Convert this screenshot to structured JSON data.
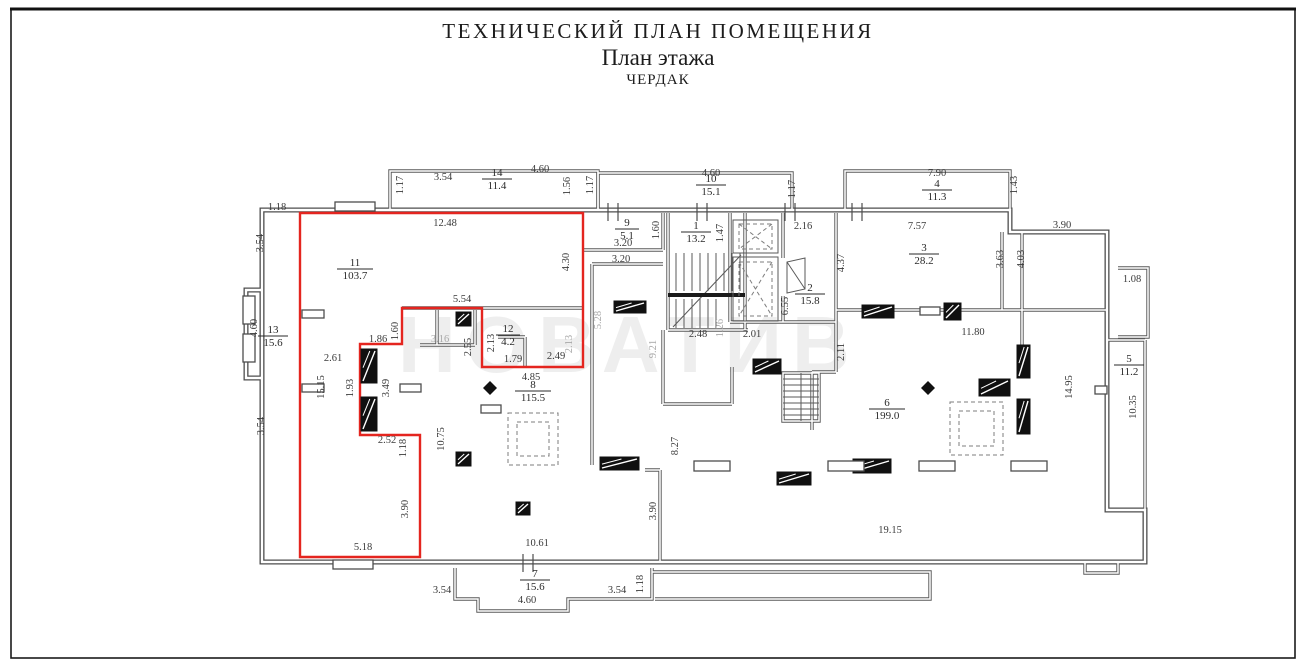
{
  "title": {
    "line1": "ТЕХНИЧЕСКИЙ ПЛАН ПОМЕЩЕНИЯ",
    "line2": "План этажа",
    "line3": "ЧЕРДАК"
  },
  "watermark": "НОВАТИВ",
  "colors": {
    "wall": "#4d4d4d",
    "red_outline": "#e4251f",
    "dim": "#3a3a3a",
    "dim_gray": "#a8a8a8",
    "room": "#2a2a2a"
  },
  "plan": {
    "rooms": [
      {
        "num": "14",
        "area": "11.4",
        "x": 497,
        "y": 178
      },
      {
        "num": "10",
        "area": "15.1",
        "x": 711,
        "y": 184
      },
      {
        "num": "4",
        "area": "11.3",
        "x": 937,
        "y": 189
      },
      {
        "num": "9",
        "area": "5.1",
        "x": 627,
        "y": 228
      },
      {
        "num": "1",
        "area": "13.2",
        "x": 696,
        "y": 231
      },
      {
        "num": "11",
        "area": "103.7",
        "x": 355,
        "y": 268
      },
      {
        "num": "3",
        "area": "28.2",
        "x": 924,
        "y": 253
      },
      {
        "num": "2",
        "area": "15.8",
        "x": 810,
        "y": 293
      },
      {
        "num": "12",
        "area": "4.2",
        "x": 508,
        "y": 334
      },
      {
        "num": "13",
        "area": "15.6",
        "x": 273,
        "y": 335
      },
      {
        "num": "8",
        "area": "115.5",
        "x": 533,
        "y": 390
      },
      {
        "num": "6",
        "area": "199.0",
        "x": 887,
        "y": 408
      },
      {
        "num": "5",
        "area": "11.2",
        "x": 1129,
        "y": 364
      },
      {
        "num": "7",
        "area": "15.6",
        "x": 535,
        "y": 579
      }
    ],
    "dims": [
      {
        "t": "1.18",
        "x": 277,
        "y": 210
      },
      {
        "t": "3.54",
        "x": 263,
        "y": 243,
        "r": 1
      },
      {
        "t": "1.17",
        "x": 403,
        "y": 185,
        "r": 1
      },
      {
        "t": "3.54",
        "x": 443,
        "y": 180
      },
      {
        "t": "4.60",
        "x": 540,
        "y": 172
      },
      {
        "t": "1.56",
        "x": 570,
        "y": 186,
        "r": 1
      },
      {
        "t": "1.17",
        "x": 593,
        "y": 185,
        "r": 1
      },
      {
        "t": "12.48",
        "x": 445,
        "y": 226
      },
      {
        "t": "4.60",
        "x": 711,
        "y": 176
      },
      {
        "t": "1.17",
        "x": 795,
        "y": 189,
        "r": 1
      },
      {
        "t": "7.90",
        "x": 937,
        "y": 176
      },
      {
        "t": "1.43",
        "x": 1017,
        "y": 185,
        "r": 1
      },
      {
        "t": "3.90",
        "x": 1062,
        "y": 228
      },
      {
        "t": "2.16",
        "x": 803,
        "y": 229
      },
      {
        "t": "7.57",
        "x": 917,
        "y": 229
      },
      {
        "t": "1.60",
        "x": 659,
        "y": 230,
        "r": 1
      },
      {
        "t": "3.20",
        "x": 623,
        "y": 246
      },
      {
        "t": "3.20",
        "x": 621,
        "y": 262
      },
      {
        "t": "1.47",
        "x": 723,
        "y": 233,
        "r": 1
      },
      {
        "t": "4.30",
        "x": 569,
        "y": 262,
        "r": 1
      },
      {
        "t": "4.37",
        "x": 844,
        "y": 263,
        "r": 1
      },
      {
        "t": "3.63",
        "x": 1003,
        "y": 259,
        "r": 1
      },
      {
        "t": "4.03",
        "x": 1024,
        "y": 259,
        "r": 1
      },
      {
        "t": "1.08",
        "x": 1132,
        "y": 282
      },
      {
        "t": "4.60",
        "x": 257,
        "y": 328,
        "r": 1
      },
      {
        "t": "3.54",
        "x": 264,
        "y": 426,
        "r": 1
      },
      {
        "t": "2.61",
        "x": 333,
        "y": 361
      },
      {
        "t": "15.15",
        "x": 324,
        "y": 387,
        "r": 1
      },
      {
        "t": "1.93",
        "x": 353,
        "y": 388,
        "r": 1
      },
      {
        "t": "3.49",
        "x": 389,
        "y": 388,
        "r": 1
      },
      {
        "t": "1.86",
        "x": 378,
        "y": 342
      },
      {
        "t": "1.60",
        "x": 398,
        "y": 331,
        "r": 1
      },
      {
        "t": "5.54",
        "x": 462,
        "y": 302
      },
      {
        "t": "3.16",
        "x": 440,
        "y": 342,
        "g": 1
      },
      {
        "t": "2.55",
        "x": 471,
        "y": 347,
        "r": 1
      },
      {
        "t": "2.13",
        "x": 494,
        "y": 343,
        "r": 1
      },
      {
        "t": "1.79",
        "x": 513,
        "y": 362
      },
      {
        "t": "2.49",
        "x": 556,
        "y": 359
      },
      {
        "t": "2.13",
        "x": 572,
        "y": 344,
        "r": 1,
        "g": 1
      },
      {
        "t": "4.85",
        "x": 531,
        "y": 380
      },
      {
        "t": "5.28",
        "x": 601,
        "y": 320,
        "r": 1,
        "g": 1
      },
      {
        "t": "9.21",
        "x": 656,
        "y": 349,
        "r": 1,
        "g": 1
      },
      {
        "t": "2.48",
        "x": 698,
        "y": 337
      },
      {
        "t": "1.26",
        "x": 723,
        "y": 328,
        "r": 1,
        "g": 1
      },
      {
        "t": "2.01",
        "x": 752,
        "y": 337
      },
      {
        "t": "6.55",
        "x": 788,
        "y": 306,
        "r": 1
      },
      {
        "t": "2.11",
        "x": 844,
        "y": 352,
        "r": 1
      },
      {
        "t": "11.80",
        "x": 973,
        "y": 335
      },
      {
        "t": "14.95",
        "x": 1072,
        "y": 387,
        "r": 1
      },
      {
        "t": "10.35",
        "x": 1136,
        "y": 407,
        "r": 1
      },
      {
        "t": "2.52",
        "x": 387,
        "y": 443
      },
      {
        "t": "1.18",
        "x": 406,
        "y": 448,
        "r": 1
      },
      {
        "t": "10.75",
        "x": 444,
        "y": 439,
        "r": 1
      },
      {
        "t": "3.90",
        "x": 408,
        "y": 509,
        "r": 1
      },
      {
        "t": "5.18",
        "x": 363,
        "y": 550
      },
      {
        "t": "10.61",
        "x": 537,
        "y": 546
      },
      {
        "t": "8.27",
        "x": 678,
        "y": 446,
        "r": 1
      },
      {
        "t": "3.90",
        "x": 656,
        "y": 511,
        "r": 1
      },
      {
        "t": "19.15",
        "x": 890,
        "y": 533
      },
      {
        "t": "3.54",
        "x": 442,
        "y": 593
      },
      {
        "t": "4.60",
        "x": 527,
        "y": 603
      },
      {
        "t": "3.54",
        "x": 617,
        "y": 593
      },
      {
        "t": "1.18",
        "x": 643,
        "y": 584,
        "r": 1
      }
    ]
  }
}
